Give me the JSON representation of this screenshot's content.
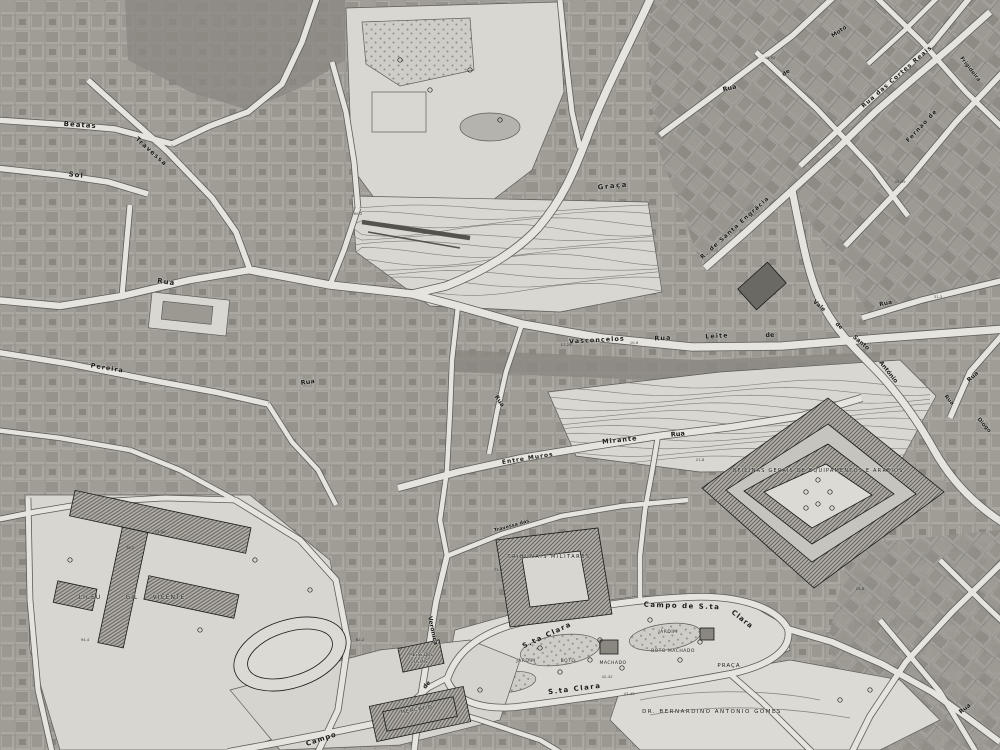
{
  "map": {
    "kind": "cadastral-city-map-grayscale",
    "colors": {
      "paper": "#dddbd5",
      "street_fill": "#e6e4de",
      "street_casing": "#5e5c56",
      "block_base": "#aba8a2",
      "block_dark": "#8a8781",
      "open_area": "#d9d7d1",
      "hatch_stroke": "#63615b",
      "contour": "#7f7d77",
      "ink": "#1a1a18",
      "water": "#b5b3ad"
    },
    "labels": [
      {
        "t": "Beatas",
        "x": 80,
        "y": 127,
        "r": 4,
        "s": 7,
        "b": 1,
        "ls": 1
      },
      {
        "t": "Sol",
        "x": 76,
        "y": 177,
        "r": 6,
        "s": 7,
        "b": 1,
        "ls": 1
      },
      {
        "t": "Travessa",
        "x": 150,
        "y": 153,
        "r": 42,
        "s": 6.5,
        "b": 1,
        "ls": 1
      },
      {
        "t": "Rua",
        "x": 166,
        "y": 284,
        "r": 8,
        "s": 7,
        "b": 1,
        "ls": 1
      },
      {
        "t": "Pereira",
        "x": 107,
        "y": 370,
        "r": 9,
        "s": 6.5,
        "b": 1,
        "ls": 1
      },
      {
        "t": "Rua",
        "x": 308,
        "y": 384,
        "r": -8,
        "s": 6.5,
        "b": 1
      },
      {
        "t": "Graça",
        "x": 613,
        "y": 188,
        "r": -6,
        "s": 7,
        "b": 1,
        "ls": 1.5
      },
      {
        "t": "Rua",
        "x": 730,
        "y": 90,
        "r": -14,
        "s": 6.5,
        "b": 1
      },
      {
        "t": "de",
        "x": 787,
        "y": 74,
        "r": -35,
        "s": 6,
        "b": 1
      },
      {
        "t": "Moto",
        "x": 840,
        "y": 33,
        "r": -35,
        "s": 6,
        "b": 1
      },
      {
        "t": "Rua das Cortes Reais",
        "x": 898,
        "y": 78,
        "r": -41,
        "s": 6,
        "b": 1,
        "ls": 1
      },
      {
        "t": "Frigideira",
        "x": 969,
        "y": 70,
        "r": 52,
        "s": 5.5,
        "b": 1
      },
      {
        "t": "Fernão de",
        "x": 923,
        "y": 127,
        "r": -47,
        "s": 6,
        "b": 1,
        "ls": 1
      },
      {
        "t": "R. de Santa Engrácia",
        "x": 736,
        "y": 229,
        "r": -42,
        "s": 6,
        "b": 1,
        "ls": 1
      },
      {
        "t": "Vasconcelos",
        "x": 597,
        "y": 342,
        "r": -3,
        "s": 6.5,
        "b": 1,
        "ls": 1
      },
      {
        "t": "Rua",
        "x": 663,
        "y": 340,
        "r": -3,
        "s": 6.5,
        "b": 1,
        "ls": 1
      },
      {
        "t": "Leite",
        "x": 717,
        "y": 338,
        "r": -3,
        "s": 6.5,
        "b": 1,
        "ls": 1
      },
      {
        "t": "de",
        "x": 770,
        "y": 337,
        "r": -3,
        "s": 6.5,
        "b": 1
      },
      {
        "t": "Vale",
        "x": 818,
        "y": 307,
        "r": 42,
        "s": 6,
        "b": 1
      },
      {
        "t": "de",
        "x": 838,
        "y": 327,
        "r": 42,
        "s": 5.5,
        "b": 1
      },
      {
        "t": "Santo",
        "x": 860,
        "y": 344,
        "r": 40,
        "s": 6,
        "b": 1
      },
      {
        "t": "António",
        "x": 887,
        "y": 373,
        "r": 52,
        "s": 6,
        "b": 1
      },
      {
        "t": "Rua",
        "x": 886,
        "y": 305,
        "r": -12,
        "s": 6,
        "b": 1
      },
      {
        "t": "Rua",
        "x": 974,
        "y": 378,
        "r": -42,
        "s": 6,
        "b": 1
      },
      {
        "t": "Rua",
        "x": 948,
        "y": 401,
        "r": 48,
        "s": 5.5,
        "b": 1
      },
      {
        "t": "Diogo",
        "x": 983,
        "y": 426,
        "r": 48,
        "s": 5.5,
        "b": 1
      },
      {
        "t": "Mirante",
        "x": 620,
        "y": 442,
        "r": -6,
        "s": 6.5,
        "b": 1,
        "ls": 1
      },
      {
        "t": "Rua",
        "x": 678,
        "y": 436,
        "r": -6,
        "s": 6.5,
        "b": 1
      },
      {
        "t": "Entre Muros",
        "x": 528,
        "y": 460,
        "r": -9,
        "s": 6,
        "b": 1,
        "ls": 1
      },
      {
        "t": "Travessa das",
        "x": 512,
        "y": 527,
        "r": -16,
        "s": 5,
        "b": 1
      },
      {
        "t": "Verónica",
        "x": 431,
        "y": 631,
        "r": 78,
        "s": 6,
        "b": 1
      },
      {
        "t": "Rua",
        "x": 498,
        "y": 402,
        "r": 55,
        "s": 6,
        "b": 1
      },
      {
        "t": "S.ta Clara",
        "x": 548,
        "y": 637,
        "r": -25,
        "s": 7,
        "b": 1,
        "ls": 1.5
      },
      {
        "t": "Campo de S.ta",
        "x": 682,
        "y": 608,
        "r": 2,
        "s": 7,
        "b": 1,
        "ls": 1.5
      },
      {
        "t": "Clara",
        "x": 741,
        "y": 621,
        "r": 38,
        "s": 7,
        "b": 1,
        "ls": 1
      },
      {
        "t": "S.ta Clara",
        "x": 575,
        "y": 691,
        "r": -7,
        "s": 7,
        "b": 1,
        "ls": 1.5
      },
      {
        "t": "Campo",
        "x": 322,
        "y": 741,
        "r": -18,
        "s": 7,
        "b": 1,
        "ls": 1
      },
      {
        "t": "de",
        "x": 428,
        "y": 686,
        "r": -48,
        "s": 6,
        "b": 1
      },
      {
        "t": "Rua",
        "x": 966,
        "y": 710,
        "r": -38,
        "s": 6,
        "b": 1
      },
      {
        "t": "JARDIM",
        "x": 668,
        "y": 633,
        "s": 4.5,
        "ls": 0.5
      },
      {
        "t": "BOTO MACHADO",
        "x": 673,
        "y": 652,
        "s": 4.5,
        "ls": 0.5
      },
      {
        "t": "JARDIM",
        "x": 526,
        "y": 662,
        "s": 4.5,
        "ls": 0.5
      },
      {
        "t": "BOTO",
        "x": 568,
        "y": 662,
        "s": 4.5,
        "ls": 0.5
      },
      {
        "t": "MACHADO",
        "x": 613,
        "y": 664,
        "s": 4.5,
        "ls": 0.5
      },
      {
        "t": "PRAÇA",
        "x": 729,
        "y": 667,
        "s": 5.5,
        "ls": 1
      },
      {
        "t": "DR. BERNARDINO ANTONIO GOMES",
        "x": 712,
        "y": 713,
        "s": 5.5,
        "ls": 1.5
      },
      {
        "t": "LICEU",
        "x": 90,
        "y": 599,
        "s": 6,
        "ls": 1
      },
      {
        "t": "GIL",
        "x": 132,
        "y": 599,
        "s": 6,
        "ls": 1
      },
      {
        "t": "VICENTE",
        "x": 169,
        "y": 599,
        "s": 6,
        "ls": 1
      },
      {
        "t": "TRIBUNAIS  MILITARES",
        "x": 549,
        "y": 558,
        "s": 5,
        "ls": 1.5
      },
      {
        "t": "OFICINAS GERAIS DE EQUIPAMENTOS E ARREIOS",
        "x": 818,
        "y": 472,
        "s": 5,
        "ls": 1.2
      },
      {
        "t": "MESSE DOS",
        "x": 421,
        "y": 656,
        "s": 4
      },
      {
        "t": "OFICIAIS",
        "x": 419,
        "y": 663,
        "s": 4
      },
      {
        "t": "MERCADO",
        "x": 417,
        "y": 711,
        "r": -10,
        "s": 5,
        "ls": 1
      }
    ],
    "parcel_numbers": [
      {
        "t": "17-23",
        "x": 566,
        "y": 346
      },
      {
        "t": "10-6",
        "x": 634,
        "y": 344
      },
      {
        "t": "42-42",
        "x": 607,
        "y": 678
      },
      {
        "t": "47-43",
        "x": 629,
        "y": 695
      },
      {
        "t": "77-20",
        "x": 160,
        "y": 533
      },
      {
        "t": "79-2",
        "x": 130,
        "y": 549
      },
      {
        "t": "73-4",
        "x": 498,
        "y": 571
      },
      {
        "t": "31-3",
        "x": 938,
        "y": 298
      },
      {
        "t": "43-49",
        "x": 900,
        "y": 183
      },
      {
        "t": "21-8",
        "x": 700,
        "y": 461
      },
      {
        "t": "94-4",
        "x": 85,
        "y": 641
      },
      {
        "t": "62-2",
        "x": 360,
        "y": 641
      },
      {
        "t": "40-52",
        "x": 770,
        "y": 59
      },
      {
        "t": "25-8",
        "x": 860,
        "y": 590
      },
      {
        "t": "69-2",
        "x": 358,
        "y": 215
      }
    ]
  }
}
